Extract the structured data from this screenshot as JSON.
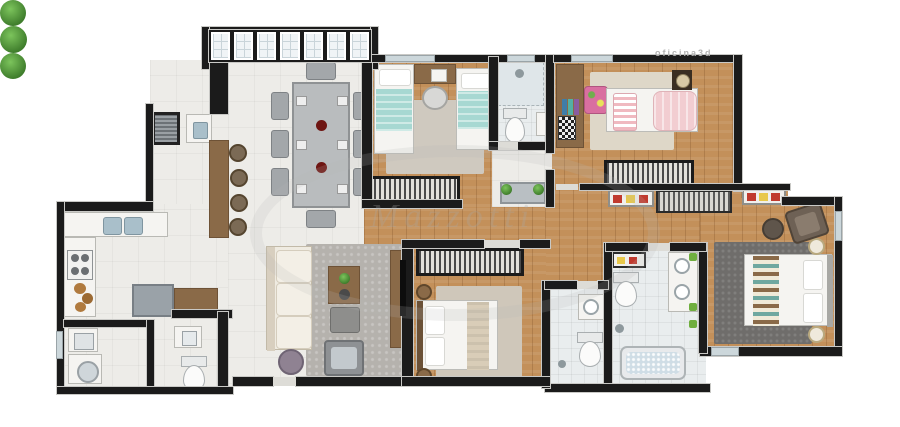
{
  "watermarks": {
    "studio_credit": "oficina3d",
    "brand": "Mazzotti"
  },
  "palette": {
    "wall": "#1b1b1b",
    "tile_floor": "#edece8",
    "bath_floor": "#e9edee",
    "wood_floor": "#c3905a",
    "rug_beige": "#cfc7ba",
    "rug_gray": "#b5b2ad",
    "rug_dark": "#6f6d6b",
    "plant_green": "#4f9c38",
    "teal_bedding": "#a7d8d2",
    "pink_bedding": "#f2cdd1",
    "white_fabric": "#f5f4f1",
    "sofa_cream": "#efebe1",
    "furniture_brown": "#8a6a48",
    "glass": "#f0f4f6"
  },
  "rooms": [
    {
      "name": "balcony-terrace",
      "furniture": [
        "glass-window-band",
        "plants",
        "barbecue-grill",
        "gourmet-sink",
        "bar-counter",
        "bar-stools"
      ]
    },
    {
      "name": "dining-area",
      "furniture": [
        "dining-table-8-seats",
        "decor-bowls"
      ]
    },
    {
      "name": "kitchen",
      "furniture": [
        "double-sink-counter",
        "cooktop",
        "food-counter",
        "work-desk"
      ]
    },
    {
      "name": "laundry-area",
      "furniture": [
        "laundry-tank",
        "washing-machine"
      ]
    },
    {
      "name": "service-bathroom",
      "furniture": [
        "sink",
        "toilet"
      ]
    },
    {
      "name": "living-room",
      "furniture": [
        "sofa",
        "area-rug",
        "coffee-table",
        "ottoman",
        "armchair",
        "pouf",
        "tv-panel"
      ]
    },
    {
      "name": "hallway",
      "furniture": [
        "decor-cabinet",
        "plants"
      ]
    },
    {
      "name": "bedroom-twin",
      "furniture": [
        "twin-bed",
        "twin-bed",
        "study-desk",
        "chair",
        "area-rug",
        "wardrobe"
      ]
    },
    {
      "name": "bathroom-social",
      "furniture": [
        "shower",
        "toilet",
        "sink"
      ]
    },
    {
      "name": "bedroom-single",
      "furniture": [
        "single-bed",
        "desk-shelf",
        "accent-chair",
        "area-rug",
        "wardrobe",
        "speaker"
      ]
    },
    {
      "name": "walk-through-closet",
      "furniture": [
        "shoe-shelf",
        "clothes-rack",
        "shoe-shelf"
      ]
    },
    {
      "name": "master-bedroom",
      "furniture": [
        "double-bed",
        "nightstand",
        "nightstand",
        "area-rug",
        "armchair",
        "ottoman"
      ]
    },
    {
      "name": "master-bathroom",
      "furniture": [
        "toilet",
        "double-sink-counter",
        "shower",
        "bathtub",
        "plants",
        "decor-shelf"
      ]
    },
    {
      "name": "bathroom-suite",
      "furniture": [
        "sink",
        "toilet",
        "shower"
      ]
    },
    {
      "name": "bedroom-double",
      "furniture": [
        "double-bed",
        "nightstand",
        "nightstand",
        "area-rug",
        "wardrobe"
      ]
    }
  ]
}
